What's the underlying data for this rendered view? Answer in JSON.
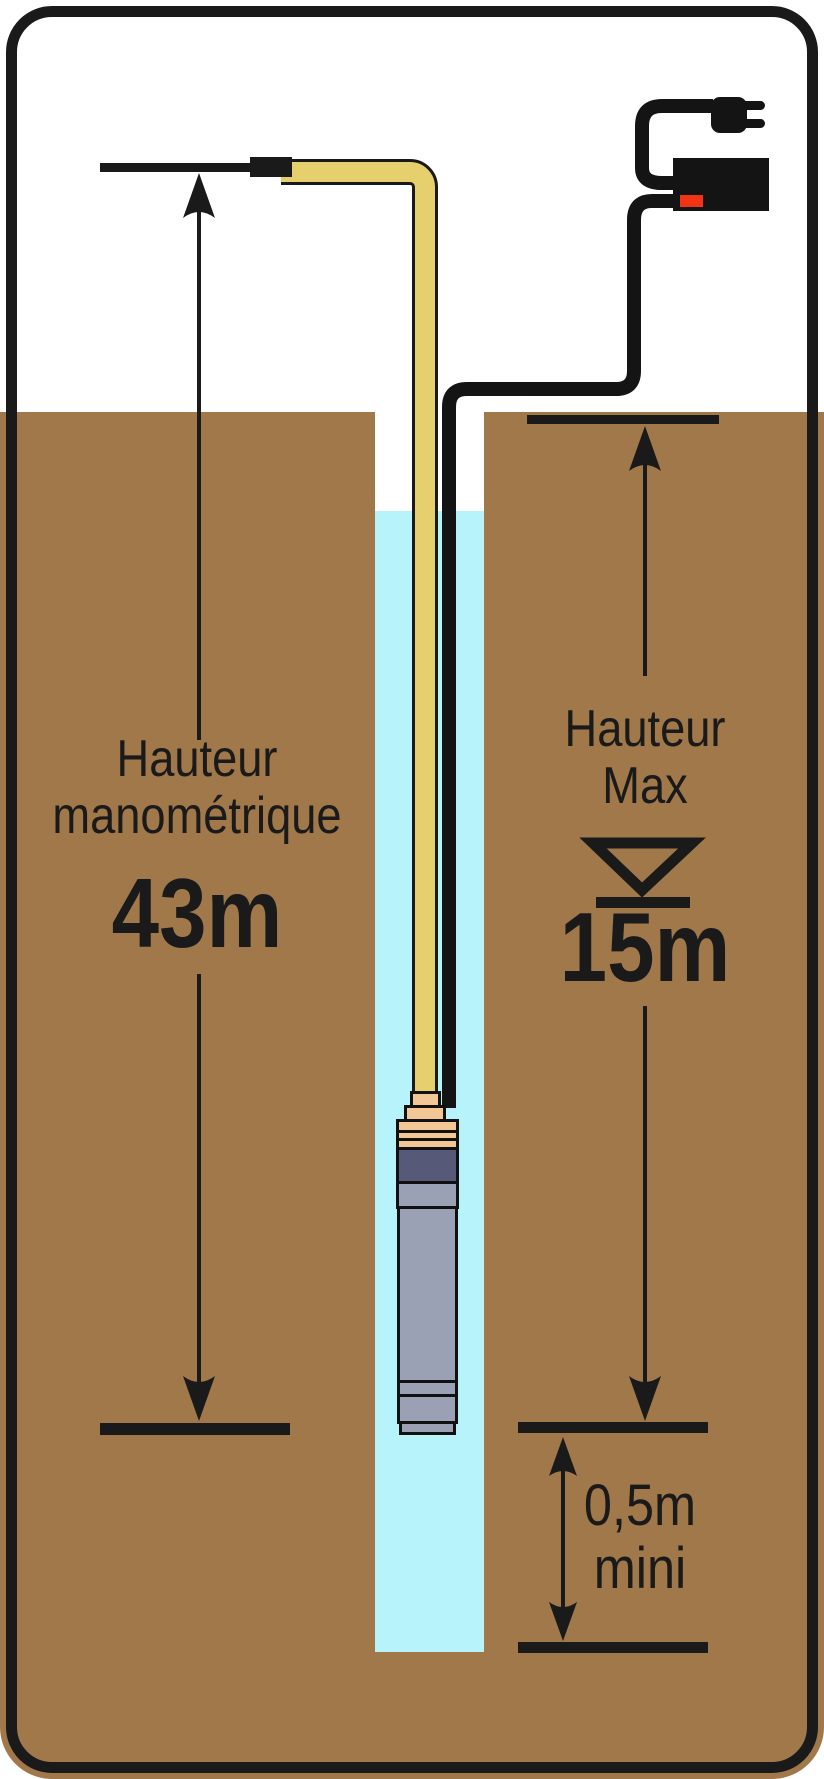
{
  "title": "Submersible well pump installation diagram",
  "labels": {
    "left_dimension": {
      "line1": "Hauteur",
      "line2": "manométrique",
      "value": "43m"
    },
    "right_dimension": {
      "line1": "Hauteur",
      "line2": "Max",
      "value": "15m"
    },
    "clearance_dimension": {
      "line1": "0,5m",
      "line2": "mini"
    }
  },
  "colors": {
    "ground": "#a1784a",
    "water": "#b6f3fb",
    "pipe": "#e6d06e",
    "fitting": "#f2c795",
    "motor": "#565a78",
    "pumpbody": "#9ba1b5",
    "cable": "#141414",
    "red": "#f03414",
    "line": "#1a1a1a"
  },
  "icons": {
    "plug": "power-plug-icon",
    "box": "float-switch-box",
    "water_level": "water-level-icon",
    "arrows": "dimension-arrow"
  }
}
